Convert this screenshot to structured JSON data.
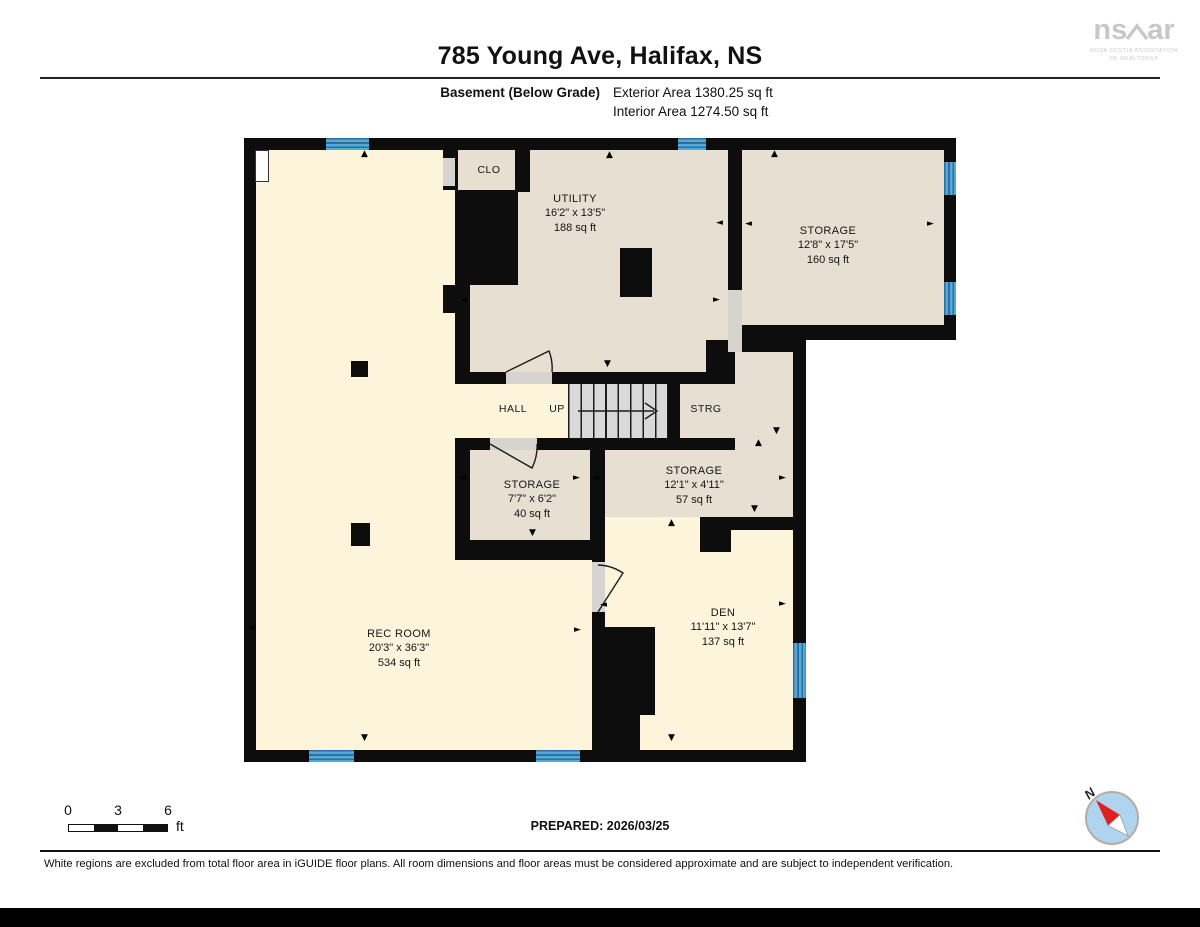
{
  "header": {
    "title": "785 Young Ave, Halifax, NS",
    "floor_label": "Basement (Below Grade)",
    "exterior_area": "Exterior Area 1380.25 sq ft",
    "interior_area": "Interior Area 1274.50 sq ft"
  },
  "logo": {
    "left": "ns",
    "right": "ar",
    "subtitle1": "NOVA SCOTIA ASSOCIATION",
    "subtitle2": "OF REALTORS®"
  },
  "rooms": {
    "clo": {
      "name": "CLO"
    },
    "utility": {
      "name": "UTILITY",
      "dims": "16'2\" x 13'5\"",
      "area": "188 sq ft"
    },
    "storage_tr": {
      "name": "STORAGE",
      "dims": "12'8\" x 17'5\"",
      "area": "160 sq ft"
    },
    "hall": {
      "name": "HALL"
    },
    "up": {
      "name": "UP"
    },
    "strg": {
      "name": "STRG"
    },
    "storage_77": {
      "name": "STORAGE",
      "dims": "7'7\" x 6'2\"",
      "area": "40 sq ft"
    },
    "storage_121": {
      "name": "STORAGE",
      "dims": "12'1\" x 4'11\"",
      "area": "57 sq ft"
    },
    "rec_room": {
      "name": "REC ROOM",
      "dims": "20'3\" x 36'3\"",
      "area": "534 sq ft"
    },
    "den": {
      "name": "DEN",
      "dims": "11'11\" x 13'7\"",
      "area": "137 sq ft"
    }
  },
  "scale_bar": {
    "tick0": "0",
    "tick1": "3",
    "tick2": "6",
    "unit": "ft"
  },
  "prepared": "PREPARED: 2026/03/25",
  "compass": {
    "north": "N"
  },
  "footer": {
    "disclaimer": "White regions are excluded from total floor area in iGUIDE floor plans. All room dimensions and floor areas must be considered approximate and are subject to independent verification."
  },
  "icons": {
    "arrow_up": "▲",
    "arrow_down": "▼",
    "arrow_left": "◄",
    "arrow_right": "►"
  },
  "colors": {
    "interior_cream": "#fcf5db",
    "interior_beige": "#e7dfd2",
    "wall_black": "#0d0d0d",
    "window_blue": "#57a8d8",
    "window_blue_dark": "#2a6f9e",
    "stair_gray": "#d9d9d9",
    "door_gray": "#d7d4cf"
  }
}
